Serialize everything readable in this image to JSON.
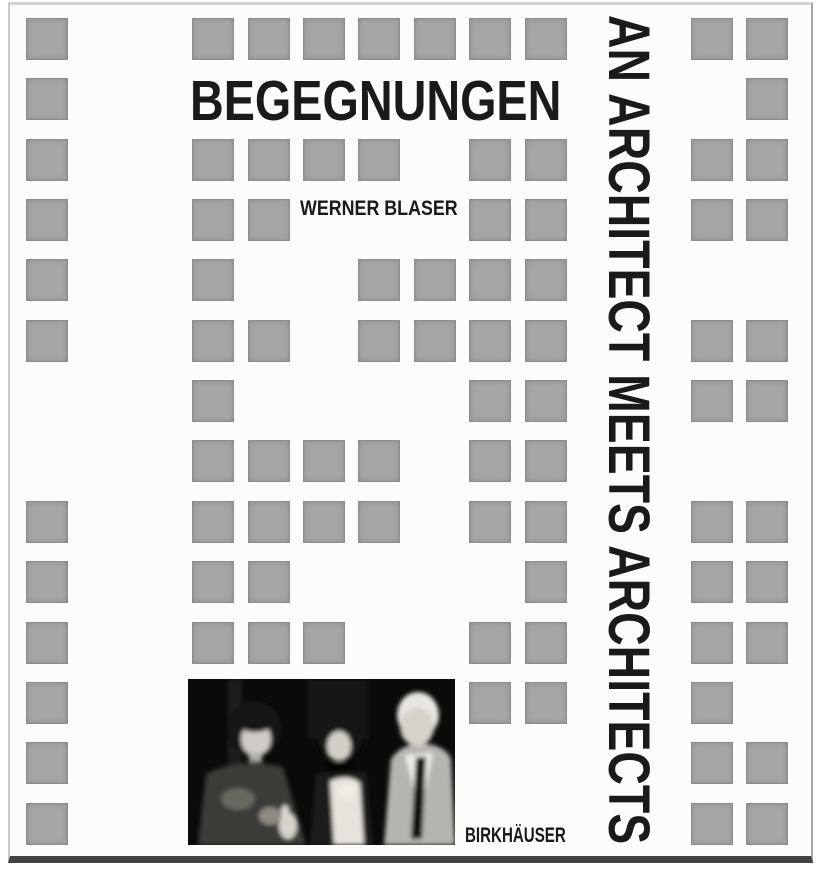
{
  "cover": {
    "title": "BEGEGNUNGEN",
    "author": "WERNER BLASER",
    "side_title": "AN ARCHITECT MEETS ARCHITECTS",
    "publisher": "BIRKHÄUSER",
    "photo_alt": "Black-and-white photograph of three people at a gathering: a woman with a dark bob haircut, a woman with dark curly hair, a choker and a white corsage, and a tall older man in a light suit, white shirt and dark tie",
    "colors": {
      "cover_bg": "#fcfcfb",
      "square_fill": "#a6a6a4",
      "square_border": "#8c8c8a",
      "ink": "#1a1a1a",
      "photo_bg": "#0a0a09",
      "page_edge_dark": "#424242"
    },
    "grid": {
      "rows": 14,
      "cols": 14,
      "origin_x": 26,
      "origin_y": 18,
      "pitch_x": 55.4,
      "pitch_y": 60.35,
      "square_size": 42,
      "filled": [
        [
          0,
          0
        ],
        [
          0,
          3
        ],
        [
          0,
          4
        ],
        [
          0,
          5
        ],
        [
          0,
          6
        ],
        [
          0,
          7
        ],
        [
          0,
          8
        ],
        [
          0,
          9
        ],
        [
          0,
          12
        ],
        [
          0,
          13
        ],
        [
          1,
          0
        ],
        [
          1,
          13
        ],
        [
          2,
          0
        ],
        [
          2,
          3
        ],
        [
          2,
          4
        ],
        [
          2,
          5
        ],
        [
          2,
          6
        ],
        [
          2,
          8
        ],
        [
          2,
          9
        ],
        [
          2,
          12
        ],
        [
          2,
          13
        ],
        [
          3,
          0
        ],
        [
          3,
          3
        ],
        [
          3,
          4
        ],
        [
          3,
          8
        ],
        [
          3,
          9
        ],
        [
          3,
          12
        ],
        [
          3,
          13
        ],
        [
          4,
          0
        ],
        [
          4,
          3
        ],
        [
          4,
          6
        ],
        [
          4,
          7
        ],
        [
          4,
          8
        ],
        [
          4,
          9
        ],
        [
          5,
          0
        ],
        [
          5,
          3
        ],
        [
          5,
          4
        ],
        [
          5,
          6
        ],
        [
          5,
          7
        ],
        [
          5,
          8
        ],
        [
          5,
          9
        ],
        [
          5,
          12
        ],
        [
          5,
          13
        ],
        [
          6,
          3
        ],
        [
          6,
          8
        ],
        [
          6,
          9
        ],
        [
          6,
          12
        ],
        [
          6,
          13
        ],
        [
          7,
          3
        ],
        [
          7,
          4
        ],
        [
          7,
          5
        ],
        [
          7,
          6
        ],
        [
          7,
          8
        ],
        [
          7,
          9
        ],
        [
          8,
          0
        ],
        [
          8,
          3
        ],
        [
          8,
          4
        ],
        [
          8,
          5
        ],
        [
          8,
          6
        ],
        [
          8,
          8
        ],
        [
          8,
          9
        ],
        [
          8,
          12
        ],
        [
          8,
          13
        ],
        [
          9,
          0
        ],
        [
          9,
          3
        ],
        [
          9,
          4
        ],
        [
          9,
          9
        ],
        [
          9,
          12
        ],
        [
          9,
          13
        ],
        [
          10,
          0
        ],
        [
          10,
          3
        ],
        [
          10,
          4
        ],
        [
          10,
          5
        ],
        [
          10,
          8
        ],
        [
          10,
          9
        ],
        [
          10,
          12
        ],
        [
          10,
          13
        ],
        [
          11,
          0
        ],
        [
          11,
          8
        ],
        [
          11,
          9
        ],
        [
          11,
          12
        ],
        [
          12,
          0
        ],
        [
          12,
          12
        ],
        [
          12,
          13
        ],
        [
          13,
          0
        ],
        [
          13,
          12
        ],
        [
          13,
          13
        ]
      ]
    }
  }
}
